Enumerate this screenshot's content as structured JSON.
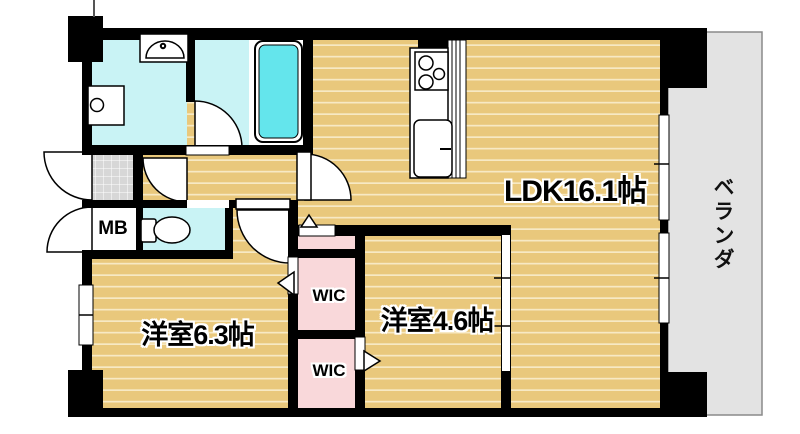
{
  "floorplan": {
    "rooms": {
      "ldk": {
        "label": "LDK16.1帖"
      },
      "bedroom_63": {
        "label": "洋室6.3帖"
      },
      "bedroom_46": {
        "label": "洋室4.6帖"
      },
      "wic_upper": {
        "label": "WIC"
      },
      "wic_lower": {
        "label": "WIC"
      },
      "meter_box": {
        "label": "MB"
      },
      "veranda": {
        "label": "ベランダ"
      }
    },
    "colors": {
      "floor_tan": "#e9c87c",
      "floor_stripe": "#f7e9c4",
      "wet_area_cyan": "#c9f3f5",
      "bathtub_cyan": "#64e5ec",
      "closet_pink": "#f9d8da",
      "entrance_tile_gray": "#d7d7d7",
      "veranda_gray": "#e3e3e3",
      "wall_black": "#000000"
    }
  }
}
